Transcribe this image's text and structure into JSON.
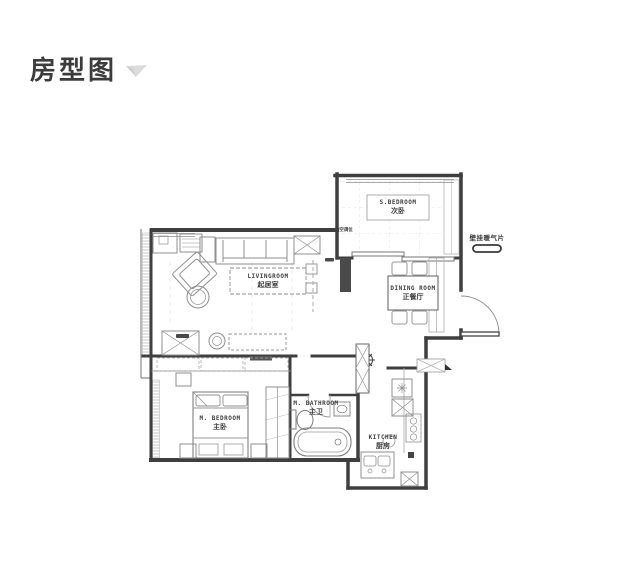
{
  "header": {
    "title": "房型图"
  },
  "floorplan": {
    "rooms": [
      {
        "name_en": "S.BEDROOM",
        "name_cn": "次卧"
      },
      {
        "name_en": "LIVINGROOM",
        "name_cn": "起居室"
      },
      {
        "name_en": "DINING ROOM",
        "name_cn": "正餐厅"
      },
      {
        "name_en": "M. BEDROOM",
        "name_cn": "主卧"
      },
      {
        "name_en": "M. BATHROOM",
        "name_cn": "主卫"
      },
      {
        "name_en": "KITCHEN",
        "name_cn": "厨房"
      }
    ],
    "annotations": [
      {
        "label": "壁挂暖气片"
      },
      {
        "label": "空调位"
      }
    ],
    "colors": {
      "wall": "#3f3f3f",
      "furniture": "#8f8f8f",
      "hatch": "#c9c9c9",
      "title_text": "#3c3c3c",
      "chevron": "#d8d8d8"
    }
  }
}
